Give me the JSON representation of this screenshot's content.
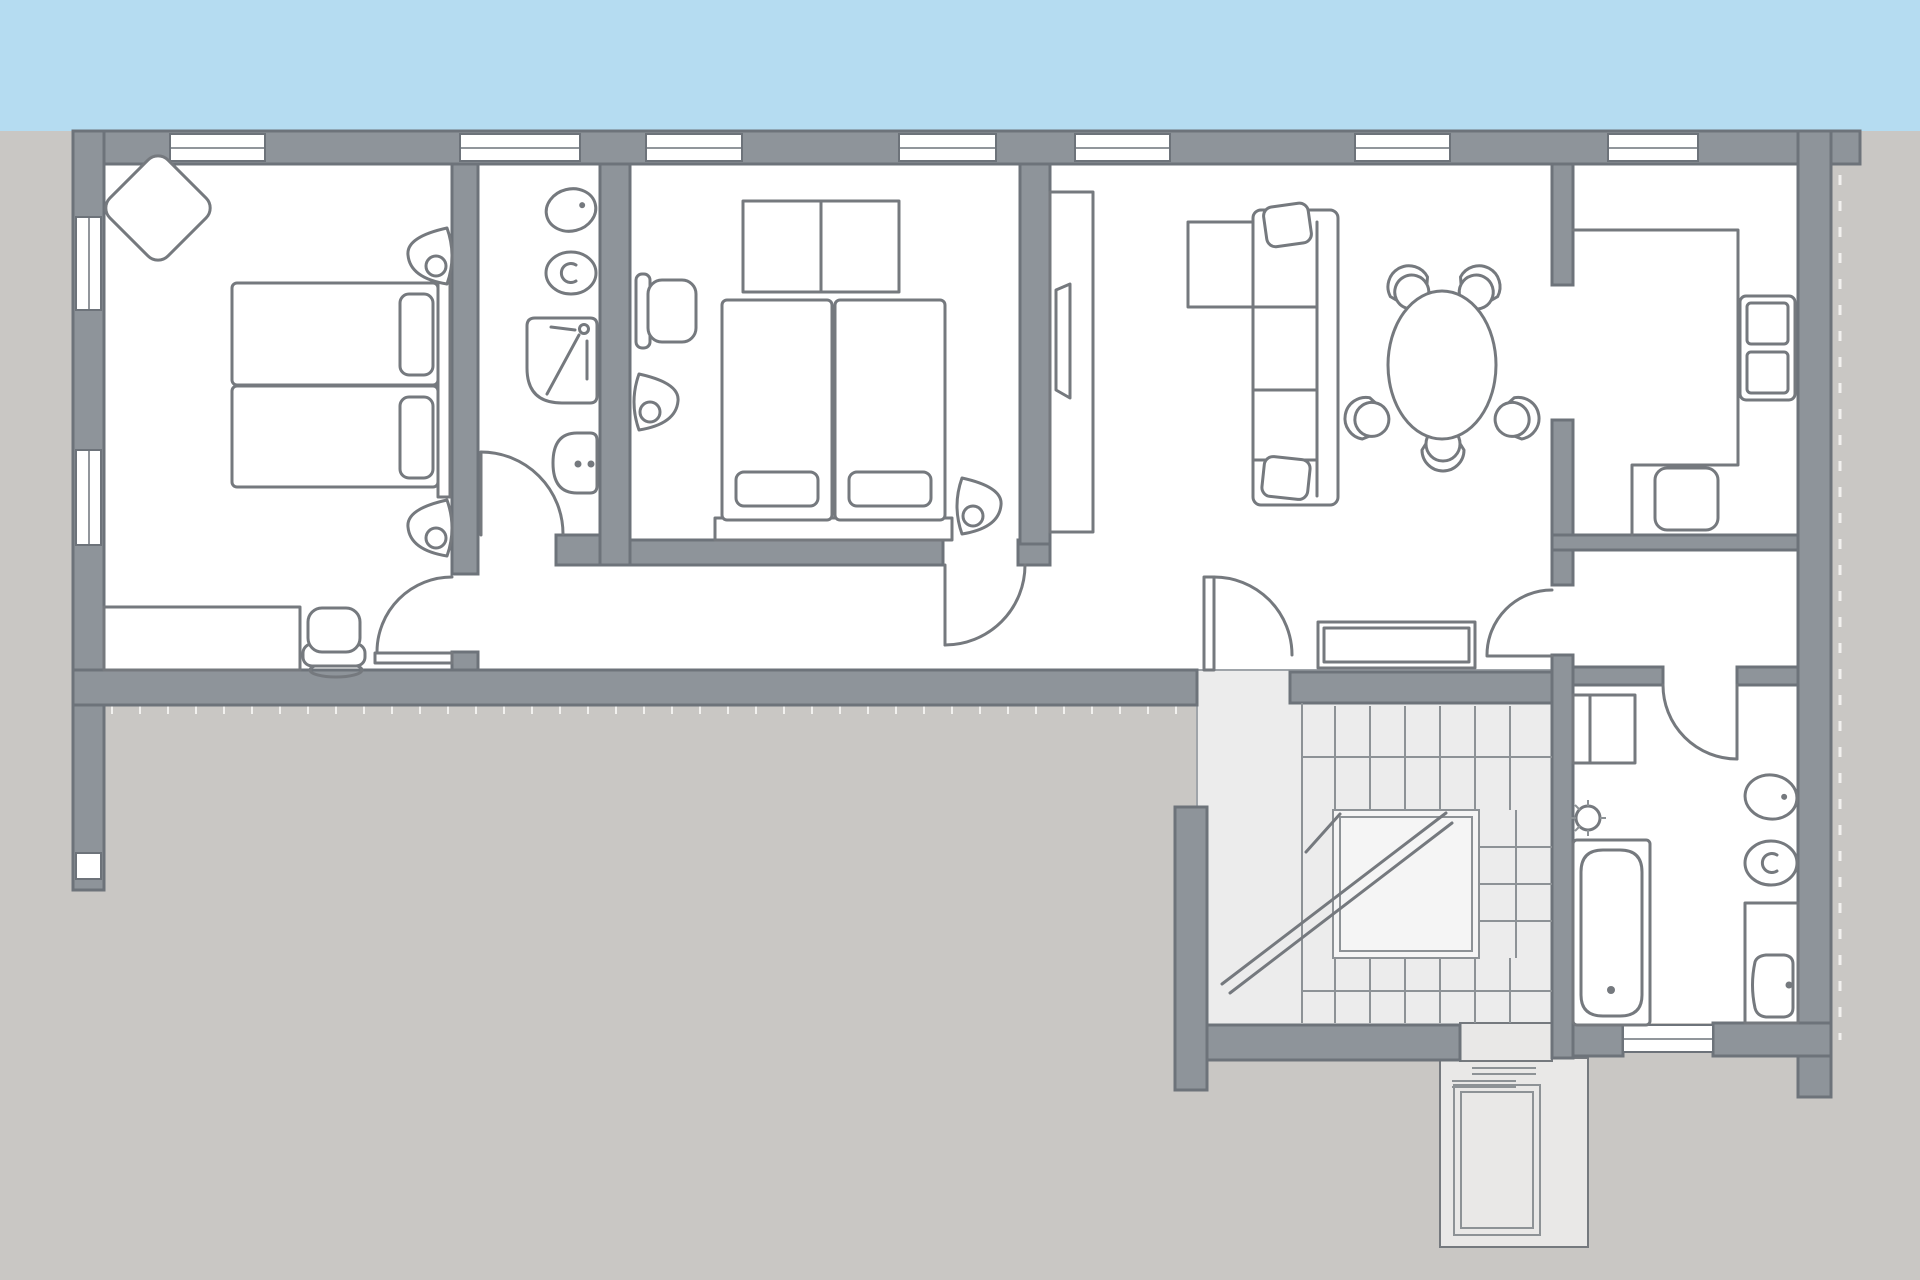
{
  "canvas": {
    "width": 1920,
    "height": 1280
  },
  "palette": {
    "sky": "#b5dcf1",
    "bg": "#c9c7c4",
    "wall": "#8e949a",
    "wall_edge": "#6d737a",
    "floor": "#ffffff",
    "stair_floor": "#ececec",
    "stair_edge": "#9fa4a9",
    "landing": "#f5f5f5",
    "stair_line": "#8d9296",
    "lift_floor": "#e9e8e7",
    "line": "#75797e",
    "tick": "#f2f1ef"
  },
  "scene": {
    "type": "architectural-floor-plan",
    "description": "Upper storey apartment plan: two bedrooms, two bathrooms, corridor, open living-dining with kitchen nook, closet, switchback staircase with landing and elevator shaft; sky band above, terrace hatching below outer walls",
    "rooms": [
      {
        "id": "bedroom-1",
        "contents": [
          "decor-diamond",
          "twin-bed",
          "wall-lamp",
          "wall-lamp",
          "desk",
          "office-chair"
        ]
      },
      {
        "id": "bathroom-1",
        "contents": [
          "toilet",
          "bidet",
          "shower",
          "washbasin"
        ]
      },
      {
        "id": "bedroom-2",
        "contents": [
          "wardrobe",
          "office-chair",
          "wall-lamp",
          "double-bed",
          "wall-lamp"
        ]
      },
      {
        "id": "living-dining",
        "contents": [
          "media-unit",
          "tv",
          "corner-sofa",
          "dining-table",
          "dining-chair",
          "dining-chair",
          "dining-chair",
          "dining-chair",
          "dining-chair"
        ]
      },
      {
        "id": "kitchen",
        "contents": [
          "counter",
          "fridge",
          "oven",
          "cooktop"
        ]
      },
      {
        "id": "hall",
        "contents": [
          "console-table",
          "entry-door"
        ]
      },
      {
        "id": "closet",
        "contents": []
      },
      {
        "id": "bathroom-2",
        "contents": [
          "washing-machine",
          "ceiling-light",
          "bathtub",
          "toilet",
          "bidet",
          "vanity-sink"
        ]
      },
      {
        "id": "stairwell",
        "contents": [
          "upper-flight",
          "landing",
          "winder-steps",
          "lower-flight",
          "direction-arrow"
        ]
      },
      {
        "id": "elevator",
        "contents": [
          "elevator-car",
          "rungs"
        ]
      }
    ],
    "door_count": 7,
    "window_count_top_wall": 7,
    "window_count_left_wall": 2
  }
}
